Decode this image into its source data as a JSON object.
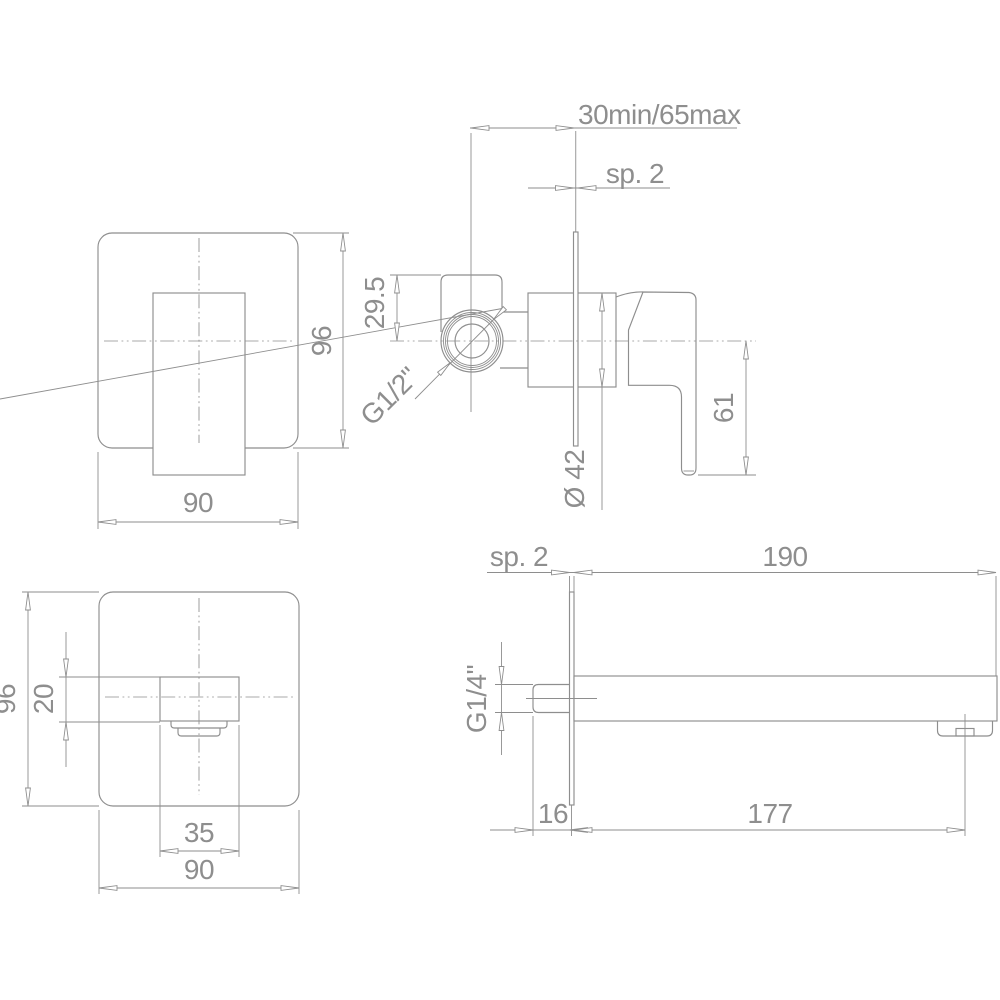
{
  "drawing": {
    "background": "#ffffff",
    "line_color": "#8e8e8e",
    "views": {
      "mixer_front": {
        "height": "96",
        "width": "90"
      },
      "mixer_side": {
        "wall_depth": "30min/65max",
        "plate_thickness": "sp. 2",
        "inlet_offset": "29.5",
        "inlet_thread": "G1/2\"",
        "body_diameter": "Ø 42",
        "handle_drop": "61"
      },
      "spout_front": {
        "height": "96",
        "spout_height": "20",
        "spout_width": "35",
        "width": "90"
      },
      "spout_side": {
        "plate_thickness": "sp. 2",
        "spout_reach": "190",
        "inlet_thread": "G1/4\"",
        "nipple_length": "16",
        "aerator_reach": "177"
      }
    }
  }
}
